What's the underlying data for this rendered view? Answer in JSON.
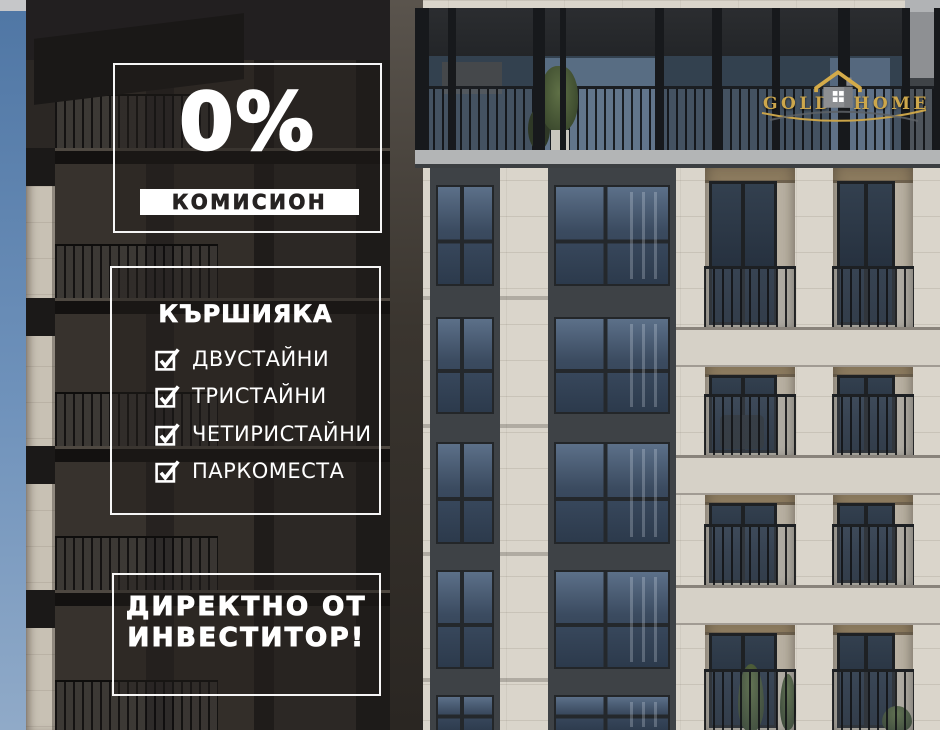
{
  "brand": {
    "word1": "GOLD",
    "word2": "HOME",
    "icon": "house-icon",
    "gold_color": "#cda74c"
  },
  "promo": {
    "percent": "0%",
    "commission_label": "КОМИСИОН"
  },
  "listing": {
    "district": "КЪРШИЯКА",
    "items": [
      {
        "label": "ДВУСТАЙНИ",
        "checked": true
      },
      {
        "label": "ТРИСТАЙНИ",
        "checked": true
      },
      {
        "label": "ЧЕТИРИСТАЙНИ",
        "checked": true
      },
      {
        "label": "ПАРКОМЕСТА",
        "checked": true
      }
    ]
  },
  "investor": {
    "line1": "ДИРЕКТНО ОТ",
    "line2": "ИНВЕСТИТОР!"
  },
  "colors": {
    "text_light": "#ffffff",
    "text_dark": "#262322",
    "sky": "#5d82ae",
    "stone": "#dad5cb",
    "dark_facade": "#2b2724",
    "glass": "#3b4b60"
  }
}
